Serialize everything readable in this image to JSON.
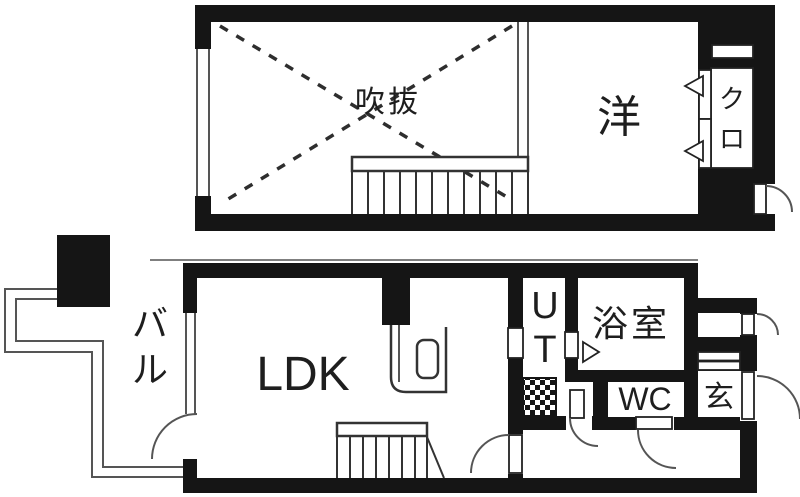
{
  "floors": {
    "upper": {
      "void": "吹抜",
      "western_room": "洋",
      "closet": "クロ"
    },
    "lower": {
      "balcony": "バル",
      "ldk": "LDK",
      "utility": "UT",
      "bath": "浴室",
      "wc": "WC",
      "entrance": "玄"
    }
  },
  "colors": {
    "wall": "#151515",
    "thin_line": "#555555",
    "stair_line": "#333333",
    "dash_line": "#2e2e2e",
    "text": "#1e1e1e",
    "bg": "#ffffff"
  }
}
